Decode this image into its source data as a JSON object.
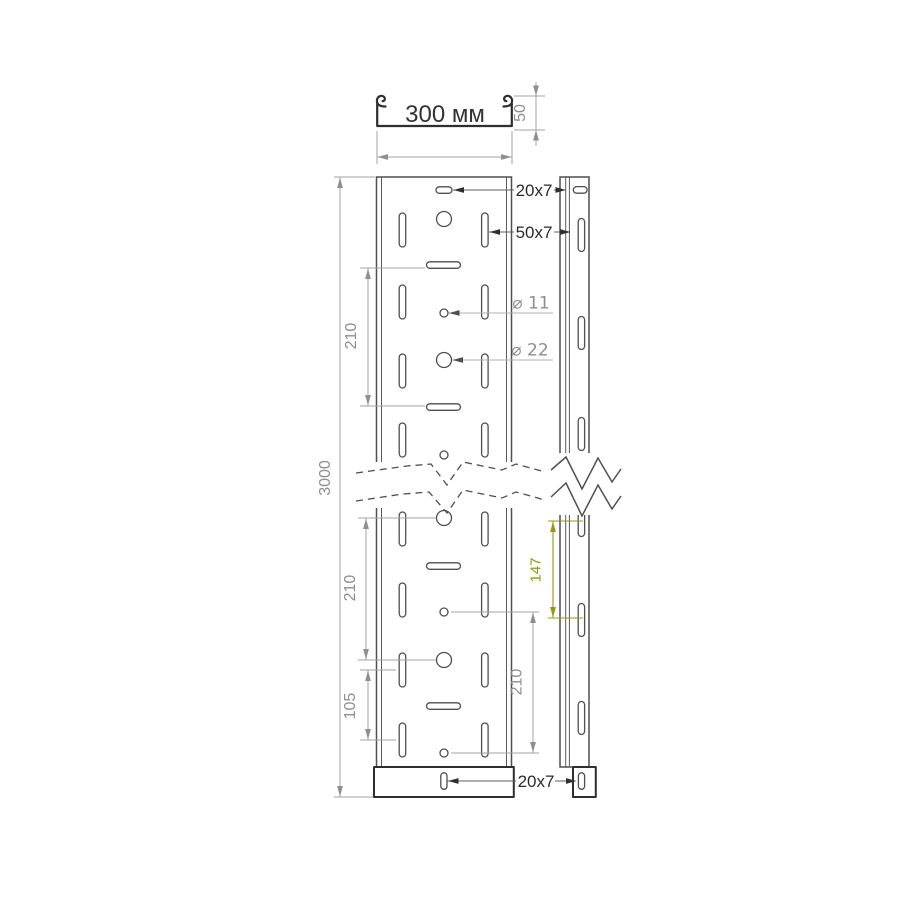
{
  "drawing": {
    "background": "#ffffff",
    "colors": {
      "outline": "#2e2e2e",
      "body_line": "#4f4f4f",
      "dim_line": "#a3a3a3",
      "dim_text": "#8e8e8e",
      "dim_arrow": "#8f8f8f",
      "callout_text": "#2b2b2b",
      "callout_arrow": "#2f2f2f",
      "main_label": "#333333",
      "accent": "#98980e"
    },
    "cross_section": {
      "width_label": "300 мм",
      "height_label": "50"
    },
    "dimensions": {
      "overall_length": "3000",
      "row_pitch_upper": "210",
      "row_pitch_lower": "210",
      "hole_pitch_right": "210",
      "slot_pitch_half": "105",
      "side_slot_pitch": "147"
    },
    "callouts": {
      "top_slot": "20x7",
      "side_slot": "50x7",
      "small_hole": "⌀ 11",
      "large_hole": "⌀ 22",
      "bottom_slot": "20x7"
    }
  }
}
